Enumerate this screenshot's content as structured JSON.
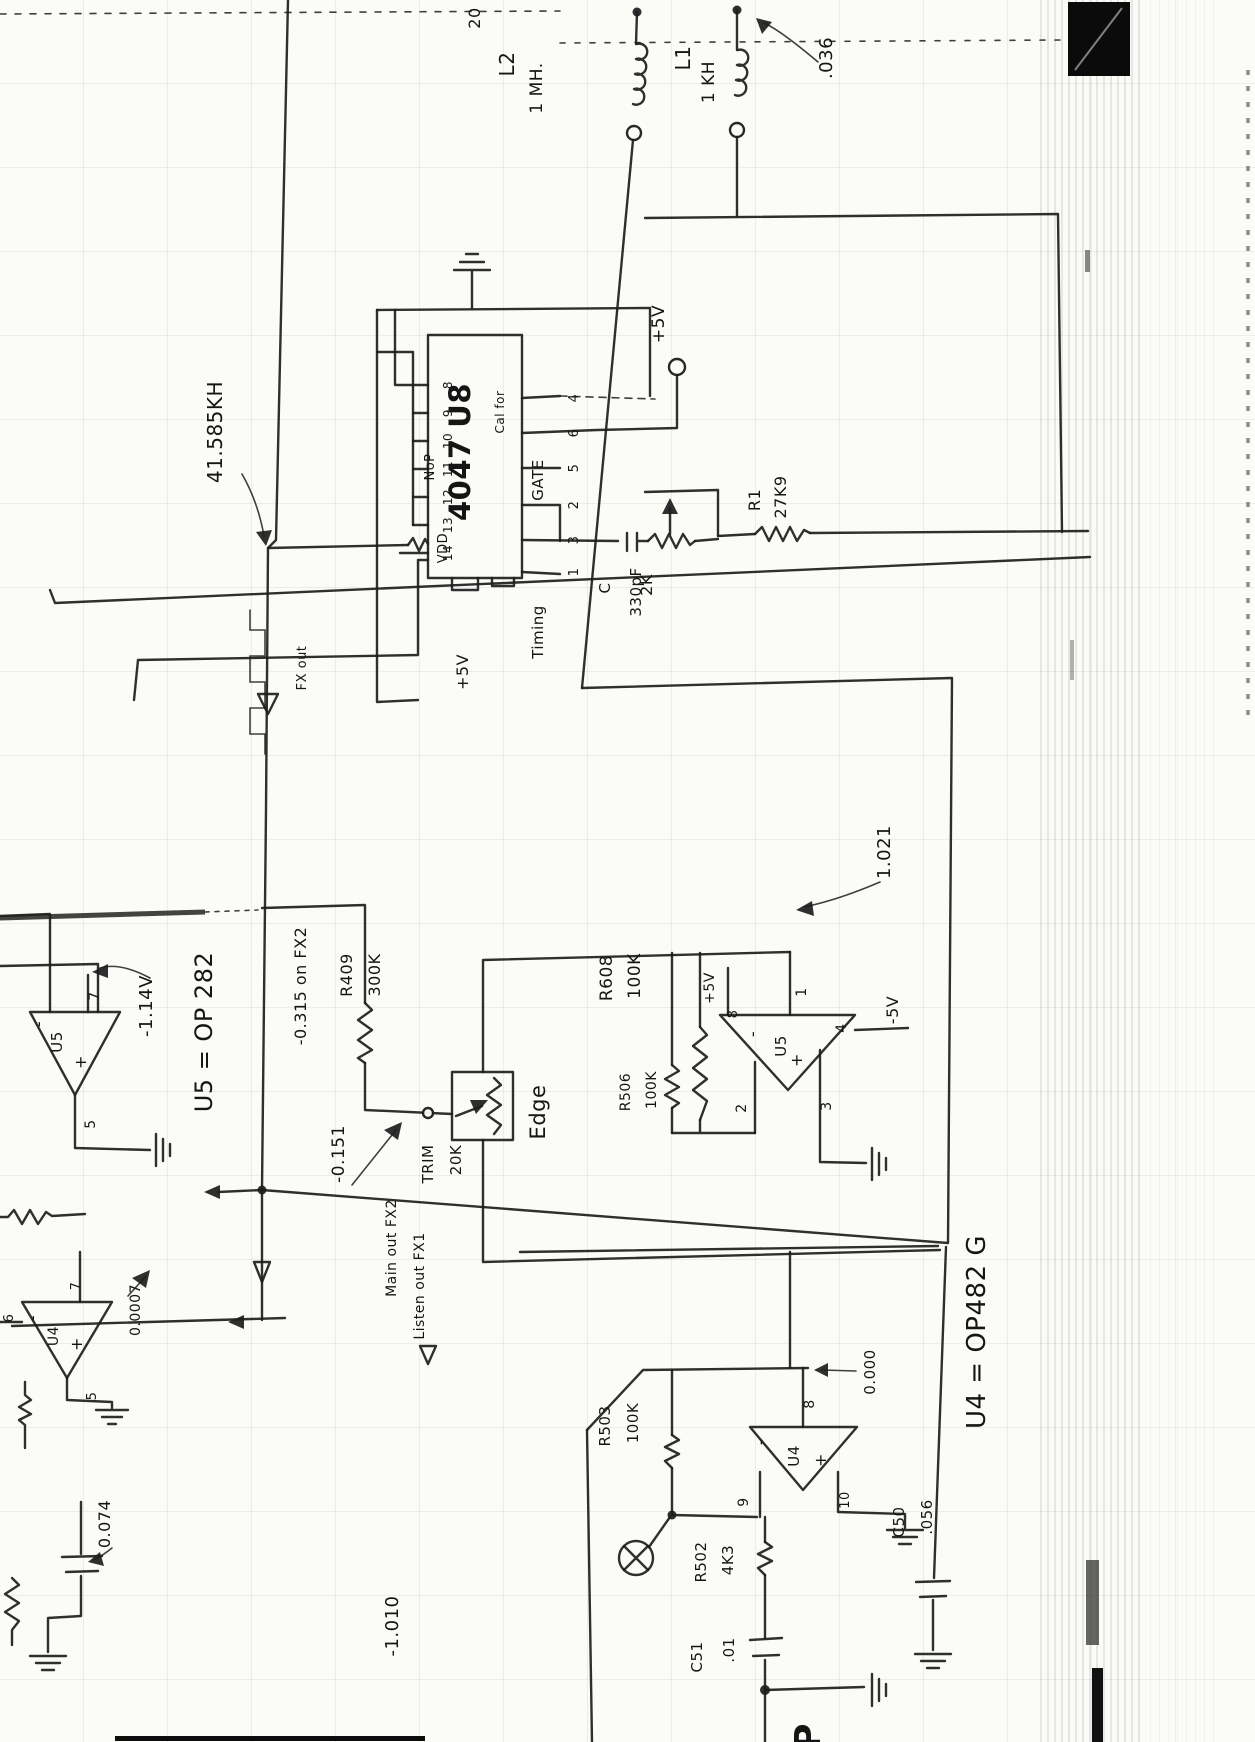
{
  "annotations": {
    "page_num": "20",
    "l_damp": ".036",
    "freq": "41.585KH",
    "fx_out": "FX out",
    "v_u5_out": "-1.14V",
    "fx2_level": "-0.315 on FX2",
    "trim_level": "-0.151",
    "main_out": "Main out FX2",
    "listen_out": "Listen out FX1",
    "u5r_out": "1.021",
    "u4r_out": "0.000",
    "u4l_out": "0.0007",
    "bottom_left_v": "-1.010",
    "cap_meas": "0.074",
    "bottom_cut": "OP"
  },
  "power": {
    "plus5v": "+5V",
    "minus5v": "-5V"
  },
  "inductors": {
    "l2": {
      "ref": "L2",
      "value": "1 MH."
    },
    "l1": {
      "ref": "L1",
      "value": "1 KH"
    }
  },
  "ic_u8": {
    "title": "4047 U8",
    "subtitle": "Cal for",
    "gate": "GATE",
    "timing": "Timing",
    "vdd": "VDD",
    "nop": "NoP",
    "left_pins": [
      "8",
      "9",
      "10",
      "11",
      "12",
      "13",
      "14"
    ],
    "right_pins": [
      "4",
      "6",
      "5",
      "2",
      "3",
      "1"
    ]
  },
  "opamps": {
    "u5_left": {
      "ref": "U5",
      "minus": "-",
      "plus": "+",
      "note": "U5 = OP 282",
      "pins": {
        "out": "7",
        "gnd": "5"
      }
    },
    "u5_right": {
      "ref": "U5",
      "minus": "-",
      "plus": "+",
      "pins": {
        "out": "1",
        "vplus": "8",
        "inv": "2",
        "noninv": "3",
        "vminus": "4"
      }
    },
    "u4_right": {
      "ref": "U4",
      "minus": "-",
      "plus": "+",
      "note": "U4 = OP482 G",
      "pins": {
        "out": "8",
        "inv": "9",
        "noninv": "10"
      }
    },
    "u4_left": {
      "ref": "U4",
      "minus": "-",
      "plus": "+",
      "pins": {
        "out": "7",
        "in_a": "6",
        "gnd": "5"
      }
    }
  },
  "resistors": {
    "r1": {
      "ref": "R1",
      "value": "27K9"
    },
    "pot_2k": {
      "value": "2K"
    },
    "r409": {
      "ref": "R409",
      "value": "300K"
    },
    "trim": {
      "ref": "TRIM",
      "value": "20K"
    },
    "r608": {
      "ref": "R608",
      "value": "100K"
    },
    "r506": {
      "ref": "R506",
      "value": "100K"
    },
    "r503": {
      "ref": "R503",
      "value": "100K"
    },
    "r502": {
      "ref": "R502",
      "value": "4K3"
    }
  },
  "capacitors": {
    "c_timing": {
      "ref": "C",
      "value": "330pF"
    },
    "c51": {
      "ref": "C51",
      "value": ".01"
    },
    "c50": {
      "ref": "C50",
      "value": ".056"
    }
  },
  "box_edge": {
    "label": "Edge"
  }
}
